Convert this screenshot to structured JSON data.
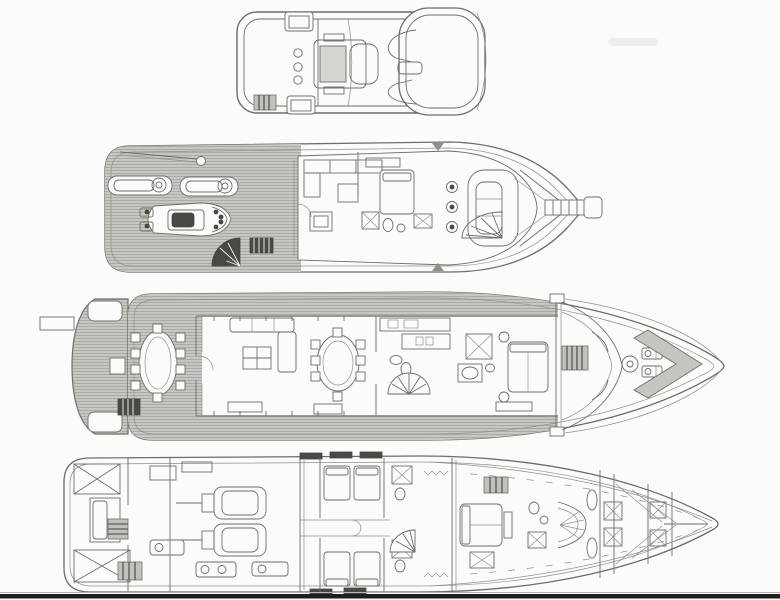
{
  "document": {
    "kind": "scanned-yacht-deck-plan-drawing",
    "decks_count": 4,
    "orientation": "bow-right"
  },
  "colors": {
    "paper": "#fbfbf9",
    "line": "#6e6d68",
    "line_soft": "#908f8a",
    "line_dark": "#45443f",
    "wood": "#c7c6c0",
    "wood_stripe": "#a5a49f",
    "dark_fill": "#4a4944",
    "scanline": "#1f1f1d"
  },
  "decks": [
    {
      "id": "flybridge-deck",
      "features": [
        "helm-console",
        "helm-seats",
        "sun-pad-aft",
        "sun-pad-forward",
        "stair-hatch",
        "forward-seating",
        "hardtop-brow"
      ]
    },
    {
      "id": "boat-deck-pilothouse",
      "features": [
        "teak-aft-deck",
        "davit-crane",
        "kayak",
        "kayak",
        "tender-pwc",
        "fan-stairs",
        "companionway-hatch",
        "skylounge-sofa",
        "coffee-table",
        "captain-cabin-bed",
        "bathroom",
        "spiral-staircase",
        "helm-chairs",
        "helm-console",
        "windshield",
        "bowsprit-mast"
      ]
    },
    {
      "id": "main-deck",
      "features": [
        "passerelle",
        "swim-platform",
        "aft-deck-oval-table",
        "deck-chairs",
        "wet-bar-hatch",
        "salon-sofa",
        "salon-coffee-table",
        "dining-table",
        "dining-chairs",
        "galley-island",
        "day-head",
        "spiral-staircase",
        "wardrobe",
        "master-stateroom-bed",
        "foredeck-hatch",
        "anchor-windlass",
        "bow-chevron"
      ]
    },
    {
      "id": "lower-deck",
      "features": [
        "lazarette-cross-braces",
        "crew-quarters",
        "ladder-hatches",
        "engine-room",
        "main-engine-port",
        "main-engine-starboard",
        "generators",
        "guest-cabin-twin-beds",
        "guest-bathrooms",
        "spiral-staircase",
        "vip-cabin-bed",
        "vip-bathroom",
        "curved-stair-bulkhead",
        "forepeak-tanks",
        "bow-centerline"
      ]
    }
  ],
  "artifacts": {
    "bottom_scan_band": true,
    "top_right_smudge": true
  }
}
